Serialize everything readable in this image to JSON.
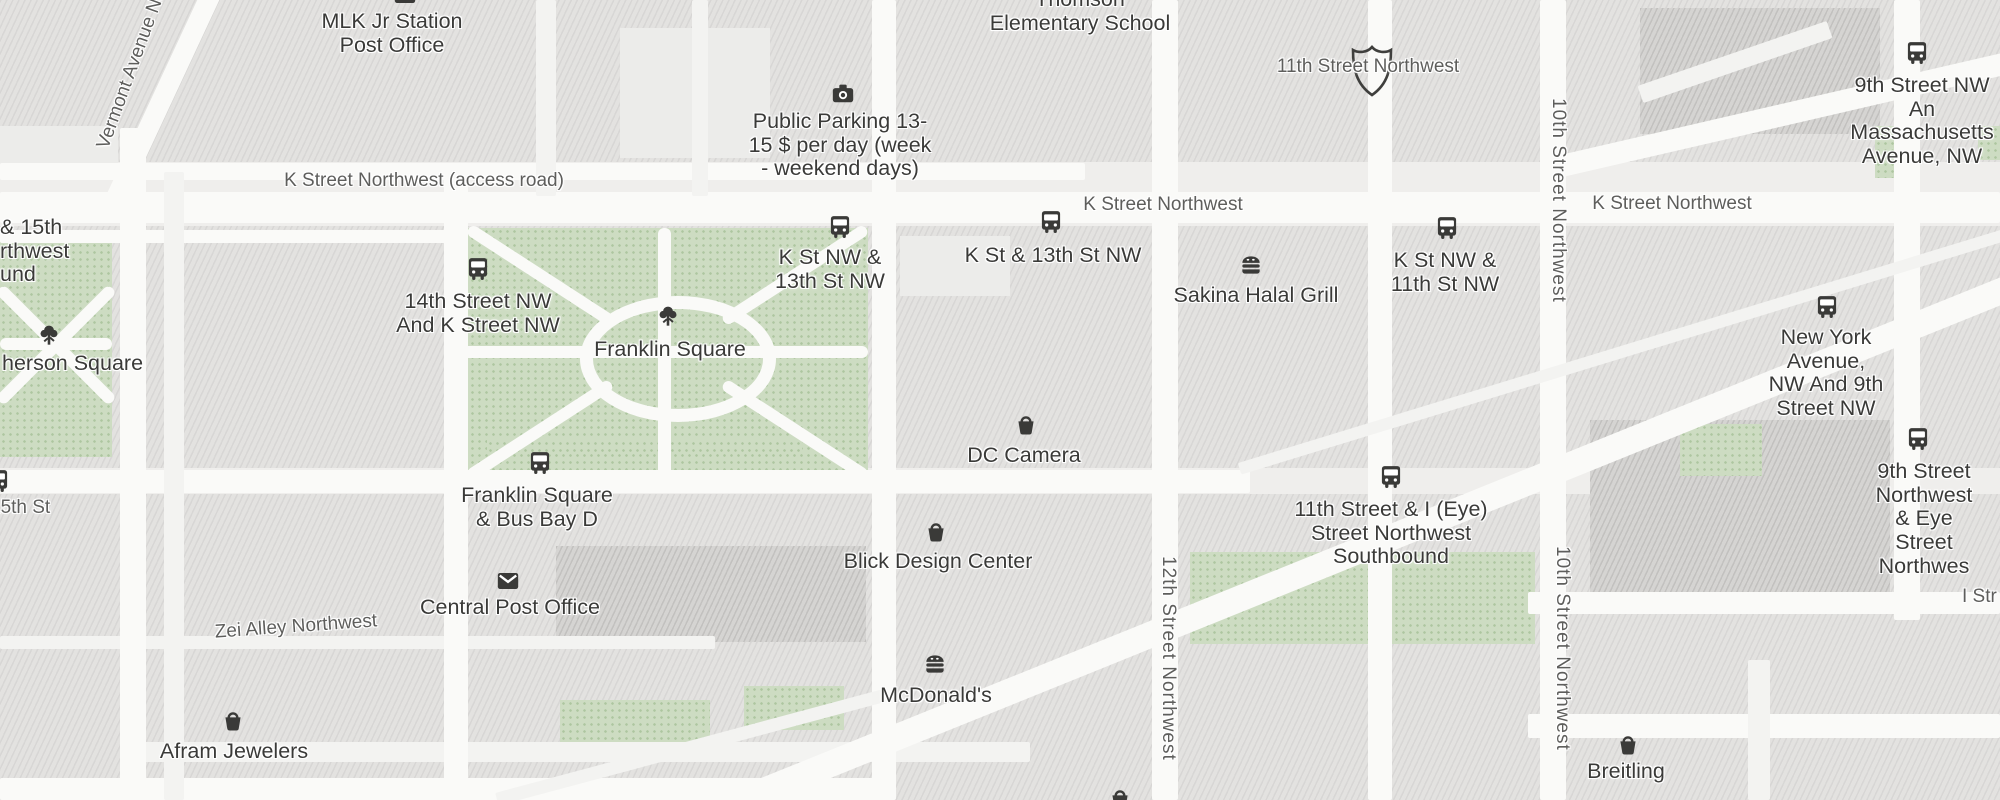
{
  "map_title": "Washington DC - Franklin Square / K Street NW area map",
  "colors": {
    "land": "#efeeec",
    "building": "#e3e2e0",
    "building_dark": "#d5d4d2",
    "park": "#cddcc2",
    "road": "#fafaf8",
    "poi_text": "#3a3a38",
    "street_text": "#5e5e5c"
  },
  "pois": [
    {
      "name": "mlk-jr-station-post-office",
      "icon": "mail",
      "text": "MLK Jr Station\nPost Office"
    },
    {
      "name": "public-parking",
      "icon": "camera",
      "text": "Public Parking 13-\n15 $ per day (week\n- weekend days)"
    },
    {
      "name": "thomson-elementary-school",
      "icon": "",
      "text": "Thomson\nElementary School"
    },
    {
      "name": "k-st-nw-and-13th-st-nw-stop",
      "icon": "bus",
      "text": "K St NW &\n13th St NW"
    },
    {
      "name": "k-st-and-13th-st-nw-stop",
      "icon": "bus",
      "text": "K St & 13th St NW"
    },
    {
      "name": "sakina-halal-grill",
      "icon": "burger",
      "text": "Sakina Halal Grill"
    },
    {
      "name": "k-st-nw-and-11th-st-nw-stop",
      "icon": "bus",
      "text": "K St NW &\n11th St NW"
    },
    {
      "name": "14th-street-nw-and-k-street-nw-stop",
      "icon": "bus",
      "text": "14th Street NW\nAnd K Street NW"
    },
    {
      "name": "franklin-square",
      "icon": "tree",
      "text": "Franklin Square"
    },
    {
      "name": "mcpherson-square",
      "icon": "tree",
      "text": "herson Square"
    },
    {
      "name": "dc-camera",
      "icon": "shop",
      "text": "DC Camera"
    },
    {
      "name": "franklin-square-bus-bay-d-stop",
      "icon": "bus",
      "text": "Franklin Square\n& Bus Bay D"
    },
    {
      "name": "blick-design-center",
      "icon": "shop",
      "text": "Blick Design Center"
    },
    {
      "name": "central-post-office",
      "icon": "mail",
      "text": "Central Post Office"
    },
    {
      "name": "mcdonalds",
      "icon": "burger",
      "text": "McDonald's"
    },
    {
      "name": "afram-jewelers",
      "icon": "shop",
      "text": "Afram Jewelers"
    },
    {
      "name": "breitling",
      "icon": "shop",
      "text": "Breitling"
    },
    {
      "name": "new-york-avenue-nw-and-9th-street-nw-stop",
      "icon": "bus",
      "text": "New York Avenue,\nNW And 9th\nStreet NW"
    },
    {
      "name": "9th-street-northwest-and-eye-street-stop",
      "icon": "bus",
      "text": "9th Street\nNorthwest & Eye\nStreet Northwes"
    },
    {
      "name": "11th-street-and-i-eye-street-southbound-stop",
      "icon": "bus",
      "text": "11th Street & I (Eye)\nStreet Northwest\nSouthbound"
    },
    {
      "name": "9th-street-nw-and-massachusetts-avenue-stop",
      "icon": "bus",
      "text": "9th Street NW An\nMassachusetts\nAvenue, NW"
    },
    {
      "name": "i-st-and-15th-partial-label",
      "icon": "",
      "text": "& 15th\nrthwest\nund"
    }
  ],
  "streets": [
    {
      "name": "k-street-access-road",
      "text": "K Street Northwest (access road)"
    },
    {
      "name": "k-street-northwest-mid",
      "text": "K Street Northwest"
    },
    {
      "name": "k-street-northwest-right",
      "text": "K Street Northwest"
    },
    {
      "name": "11th-street-northwest",
      "text": "11th Street Northwest"
    },
    {
      "name": "zei-alley-northwest",
      "text": "Zei Alley Northwest"
    },
    {
      "name": "15th-st",
      "text": "15th St"
    },
    {
      "name": "i-street-partial",
      "text": "I Str"
    },
    {
      "name": "vermont-avenue-northwest",
      "text": "Vermont Avenue Nor"
    },
    {
      "name": "10th-street-northwest-upper",
      "text": "10th Street Northwest"
    },
    {
      "name": "10th-street-northwest-lower",
      "text": "10th Street Northwest"
    },
    {
      "name": "12th-street-northwest",
      "text": "12th Street Northwest"
    }
  ]
}
